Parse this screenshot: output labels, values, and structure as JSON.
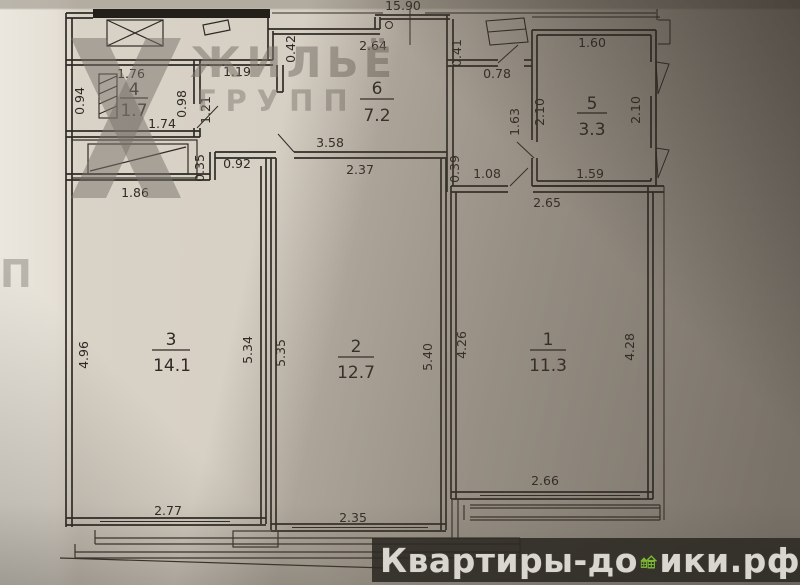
{
  "brand": {
    "line1": "ЖИЛЬЁ",
    "line2": "ГРУПП",
    "partial": "П"
  },
  "footer": {
    "prefix": "Квартиры-до",
    "suffix": "ики.рф"
  },
  "colors": {
    "accent_green": "#7cb832",
    "paper": "#d5cec2",
    "line": "#2e2b26",
    "footer_bg": "#2c2823"
  },
  "plan": {
    "overall_top": "15.90",
    "room4": {
      "num": "4",
      "area": "1.7",
      "w_top": "1.76",
      "w_left": "0.94",
      "w_right": "0.98",
      "w_bottom": "1.74"
    },
    "room6": {
      "num": "6",
      "area": "7.2",
      "w_top": "2.64"
    },
    "room5": {
      "num": "5",
      "area": "3.3",
      "w_top": "1.60",
      "w_left": "2.10",
      "w_right": "2.10",
      "w_bottom": "1.59"
    },
    "room3": {
      "num": "3",
      "area": "14.1",
      "w_left": "4.96",
      "w_right": "5.34",
      "w_bottom": "2.77"
    },
    "room2": {
      "num": "2",
      "area": "12.7",
      "w_top": "2.37",
      "w_left": "5.35",
      "w_right": "5.40",
      "w_bottom": "2.35"
    },
    "room1": {
      "num": "1",
      "area": "11.3",
      "w_top": "2.65",
      "w_left": "4.26",
      "w_right": "4.28",
      "w_bottom": "2.66"
    },
    "hall": {
      "w119": "1.19",
      "w121": "1.21",
      "w042": "0.42",
      "w041": "0.41",
      "w078": "0.78",
      "w163": "1.63",
      "w358": "3.58",
      "w035": "0.35",
      "w092": "0.92",
      "w039": "0.39",
      "w108": "1.08",
      "w186": "1.86"
    }
  }
}
